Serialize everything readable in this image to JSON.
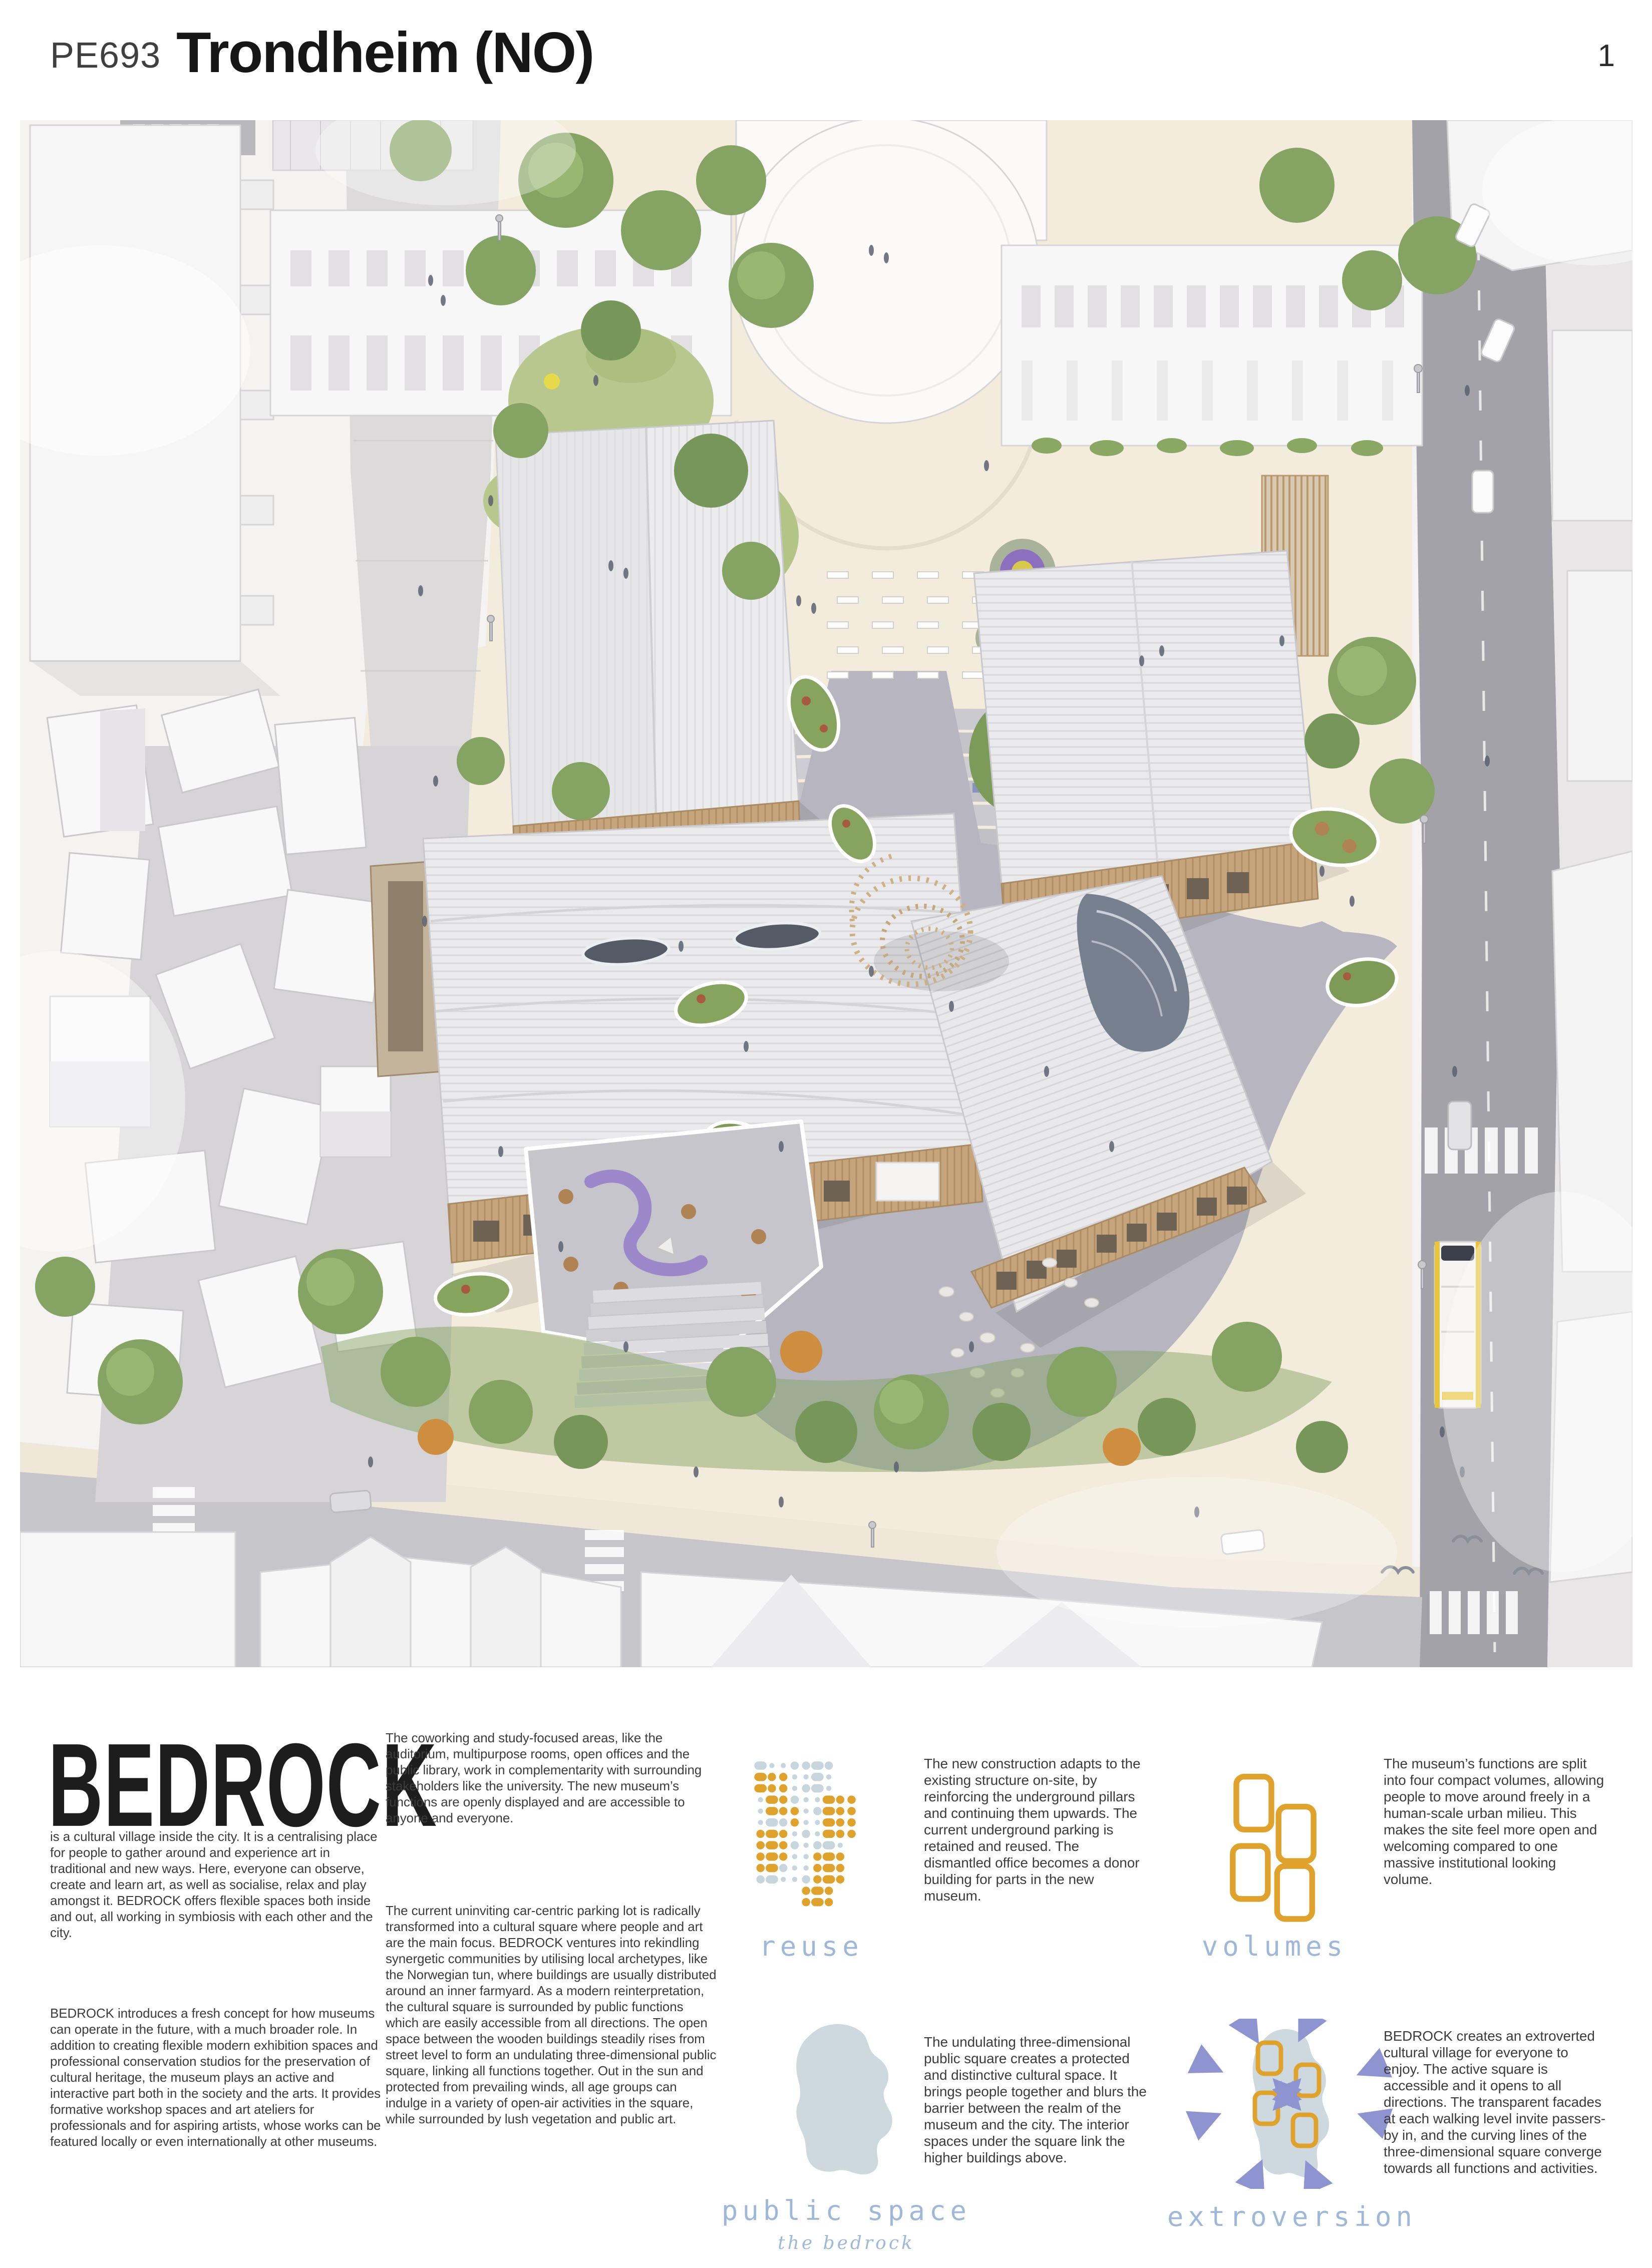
{
  "header": {
    "project_code": "PE693",
    "title": "Trondheim (NO)",
    "page_number": "1"
  },
  "brand": {
    "name": "BEDROCK",
    "intro": "is a cultural village inside the city. It is a centralising place for people to gather around and experience art in traditional and new ways. Here, everyone can observe, create and learn art, as well as socialise, relax and play amongst it. BEDROCK offers flexible spaces both inside and out, all working in symbiosis with each other and the city.",
    "concept": "BEDROCK introduces a fresh concept for how museums can operate in the future, with a much broader role. In addition to creating flexible modern exhibition spaces and professional conservation studios for the preservation of cultural heritage, the museum plays an active and interactive part both in the society and the arts. It provides formative workshop spaces and art ateliers for professionals and for aspiring artists, whose works can be featured locally or even internationally at other museums."
  },
  "column2": {
    "paragraph1": "The coworking and study-focused areas, like the auditorium, multipurpose rooms, open offices and the public library, work in complementarity with surrounding stakeholders like the university. The new museum’s functions are openly displayed and are accessible to anyone and everyone.",
    "paragraph2": "The current uninviting car-centric parking lot is radically transformed into a cultural square where people and art are the main focus.  BEDROCK ventures into rekindling synergetic communities by utilising local archetypes, like the Norwegian tun, where buildings are usually distributed around an inner farmyard. As a modern reinterpretation, the cultural square is surrounded by public functions which are easily accessible from all directions. The open space between the wooden buildings steadily rises from street level to form an undulating three-dimensional public square, linking all functions together. Out in the sun and protected from prevailing winds, all age groups can indulge in a variety of open-air activities in the square, while surrounded by lush vegetation and public art."
  },
  "diagrams": {
    "reuse": {
      "label": "reuse",
      "text": "The new construction adapts to the existing structure on-site, by reinforcing the underground pillars and continuing them upwards. The current underground parking is retained and reused. The dismantled office becomes a donor building for parts in the new museum.",
      "pattern": [
        "BssbbBb...",
        "OoossBs...",
        "OoosbBs...",
        "sOobssOoo.",
        "sOoosbOoo.",
        "sBbossOoo.",
        "oOosbsOoo.",
        "oOobsbBs..",
        "oOossoOo..",
        "oObssoOo..",
        "bBssboOo..",
        "....oOo...",
        "....oOo..."
      ]
    },
    "volumes": {
      "label": "volumes",
      "text": "The museum’s functions are split into four compact volumes, allowing people to move around freely in a human-scale urban milieu. This makes the site feel more open and welcoming compared to one massive institutional looking volume."
    },
    "public_space": {
      "label": "public space",
      "sublabel": "the bedrock",
      "text": "The undulating three-dimensional public square creates a protected and distinctive cultural space. It brings people together and blurs the barrier between the realm of the museum and the city. The interior spaces under the square link the higher buildings above."
    },
    "extroversion": {
      "label": "extroversion",
      "text": "BEDROCK creates an extroverted cultural village for everyone to enjoy. The active square is accessible and it opens to all directions. The transparent facades at each walking level invite passers-by in, and the curving lines of the three-dimensional square converge towards all functions and activities."
    }
  },
  "colors": {
    "accent_orange": "#DFA22D",
    "diagram_blue": "#C7D5DD",
    "label_blue": "#9FB8DA",
    "arrow_purple": "#8D94CF",
    "blob_gray_blue": "#CDD9DE"
  }
}
